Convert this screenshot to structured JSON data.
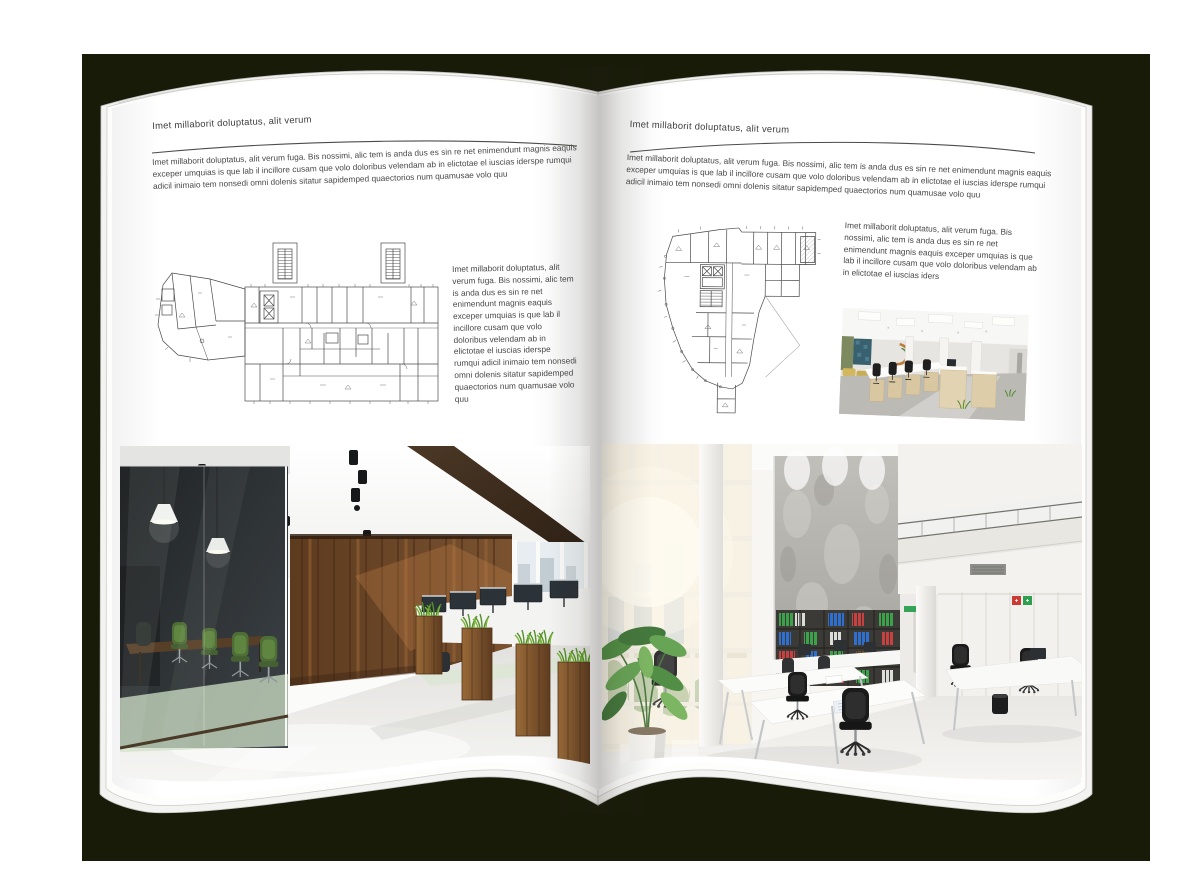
{
  "colors": {
    "backdrop": "#191b09",
    "page": "#ffffff",
    "ink": "#434343"
  },
  "left_page": {
    "header": "Imet millaborit doluptatus, alit verum",
    "intro": "Imet millaborit doluptatus, alit verum fuga. Bis nossimi, alic tem is anda dus es sin re net enimendunt magnis eaquis exceper umquias is que lab il incillore cusam que volo doloribus velendam ab in elictotae el iuscias iderspe rumqui adicil inimaio tem nonsedi omni dolenis sitatur sapidemped quaectorios num quamusae volo quu",
    "caption": "Imet millaborit doluptatus, alit verum fuga. Bis nossimi, alic tem is anda dus es sin re net enimendunt magnis eaquis exceper umquias is que lab il incillore cusam que volo doloribus velendam ab in elictotae el iuscias iderspe rumqui adicil inimaio tem nonsedi omni dolenis sitatur sapidemped quaectorios num quamusae volo quu"
  },
  "right_page": {
    "header": "Imet millaborit doluptatus, alit verum",
    "intro": "Imet millaborit doluptatus, alit verum fuga. Bis nossimi, alic tem is anda dus es sin re net enimendunt magnis eaquis exceper umquias is que lab il incillore cusam que volo doloribus velendam ab in elictotae el iuscias iderspe rumqui adicil inimaio tem nonsedi omni dolenis sitatur sapidemped quaectorios num quamusae volo quu",
    "caption": "Imet millaborit doluptatus, alit verum fuga. Bis nossimi, alic tem is anda dus es sin re net enimendunt magnis eaquis exceper umquias is que lab il incillore cusam que volo doloribus velendam ab in elictotae el iuscias iders"
  }
}
